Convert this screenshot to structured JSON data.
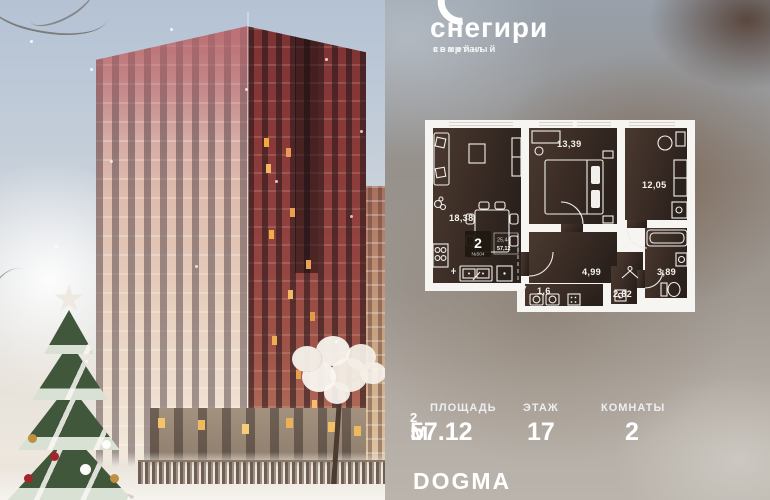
{
  "brand": {
    "wordmark": "снегири",
    "tagline_line1": "семейный",
    "tagline_line2": "квартал"
  },
  "plan": {
    "badge": {
      "rooms_count": "2",
      "unit_number": "№504",
      "living_area": "25,44",
      "total_area": "57,12"
    },
    "rooms": {
      "living": "18,38",
      "bedroom": "13,39",
      "bedroom2": "12,05",
      "hall": "4,99",
      "bathroom": "3,89",
      "corridor": "2,82",
      "laundry": "1,6"
    }
  },
  "stats": [
    {
      "label": "ПЛОЩАДЬ",
      "value": "57.12",
      "unit": " м",
      "sup": "2"
    },
    {
      "label": "ЭТАЖ",
      "value": "17"
    },
    {
      "label": "КОМНАТЫ",
      "value": "2"
    }
  ],
  "developer": {
    "logo": "DOGMA"
  },
  "colors": {
    "building_left_face": "#dcb8ab",
    "building_right_face": "#8a3a38",
    "panel_brown": "#6e5244",
    "panel_grey": "#9aa2ac",
    "plan_walls": "#f7f5f2",
    "plan_room_dark": "#3a2c25",
    "ornament_red": "#a3242a",
    "ornament_gold": "#c08f3f",
    "lit_window": "#f2a93e",
    "text": "#ffffff"
  }
}
